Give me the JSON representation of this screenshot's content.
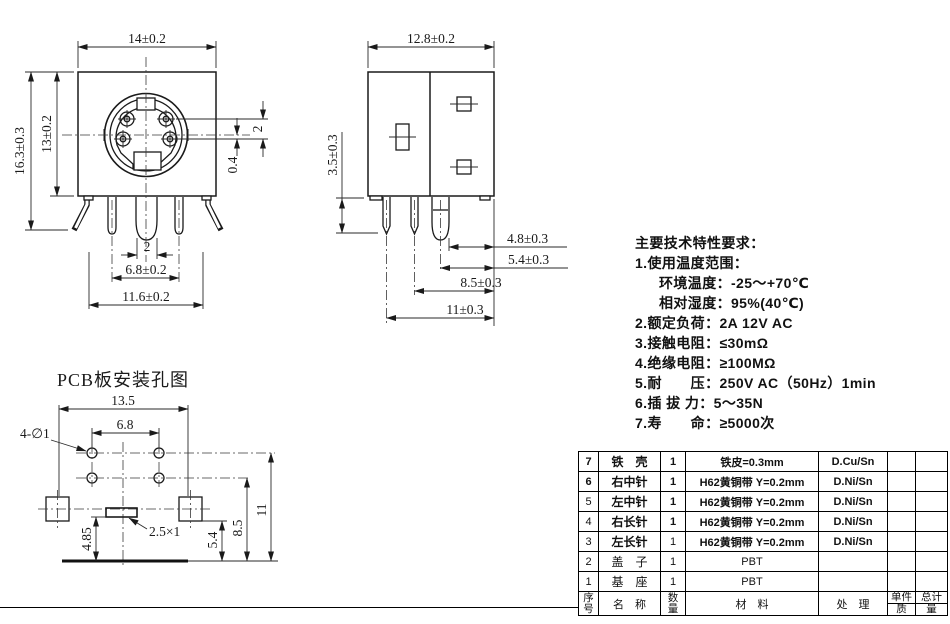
{
  "drawing": {
    "front": {
      "name": "front view",
      "dim_width": "14±0.2",
      "dim_height_outer": "16.3±0.3",
      "dim_height_inner": "13±0.2",
      "dim_pin_row_pitch": "2",
      "dim_pin_axis_offset": "0.4",
      "dim_center_pin": "2",
      "dim_pin_pitch": "6.8±0.2",
      "dim_leg_pitch": "11.6±0.2"
    },
    "side": {
      "name": "side view",
      "dim_width": "12.8±0.2",
      "dim_leg_length": "3.5±0.3",
      "dim_a": "4.8±0.3",
      "dim_b": "5.4±0.3",
      "dim_c": "8.5±0.3",
      "dim_d": "11±0.3"
    },
    "pcb": {
      "title": "PCB板安装孔图",
      "dim_board_width": "13.5",
      "dim_hole_pitch": "6.8",
      "label_holes": "4-∅1",
      "label_slot": "2.5×1",
      "dim_a": "4.85",
      "dim_b": "5.4",
      "dim_c": "8.5",
      "dim_d": "11"
    }
  },
  "specs": {
    "title": "主要技术特性要求：",
    "lines": [
      "1.使用温度范围：",
      "环境温度：-25～+70℃",
      "相对湿度：95%(40℃)",
      "2.额定负荷：2A 12V AC",
      "3.接触电阻：≤30mΩ",
      "4.绝缘电阻：≥100MΩ",
      "5.耐　　压：250V AC（50Hz）1min",
      "6.插 拔 力：5～35N",
      "7.寿　　命：≥5000次"
    ]
  },
  "bom": {
    "headers": {
      "no_top": "序",
      "no_bottom": "号",
      "name": "名　称",
      "qty_top": "数",
      "qty_bottom": "量",
      "material": "材　料",
      "treatment": "处　理",
      "unit": "单件",
      "total": "总计",
      "mass_left": "质",
      "mass_right": "量"
    },
    "rows": [
      {
        "no": "7",
        "name": "铁　壳",
        "qty": "1",
        "material": "铁皮=0.3mm",
        "treatment": "D.Cu/Sn"
      },
      {
        "no": "6",
        "name": "右中针",
        "qty": "1",
        "material": "H62黄铜带 Y=0.2mm",
        "treatment": "D.Ni/Sn"
      },
      {
        "no": "5",
        "name": "左中针",
        "qty": "1",
        "material": "H62黄铜带 Y=0.2mm",
        "treatment": "D.Ni/Sn"
      },
      {
        "no": "4",
        "name": "右长针",
        "qty": "1",
        "material": "H62黄铜带 Y=0.2mm",
        "treatment": "D.Ni/Sn"
      },
      {
        "no": "3",
        "name": "左长针",
        "qty": "1",
        "material": "H62黄铜带 Y=0.2mm",
        "treatment": "D.Ni/Sn"
      },
      {
        "no": "2",
        "name": "盖　子",
        "qty": "1",
        "material": "PBT",
        "treatment": ""
      },
      {
        "no": "1",
        "name": "基　座",
        "qty": "1",
        "material": "PBT",
        "treatment": ""
      }
    ]
  },
  "colors": {
    "line": "#1a1a1a",
    "background": "#ffffff"
  }
}
